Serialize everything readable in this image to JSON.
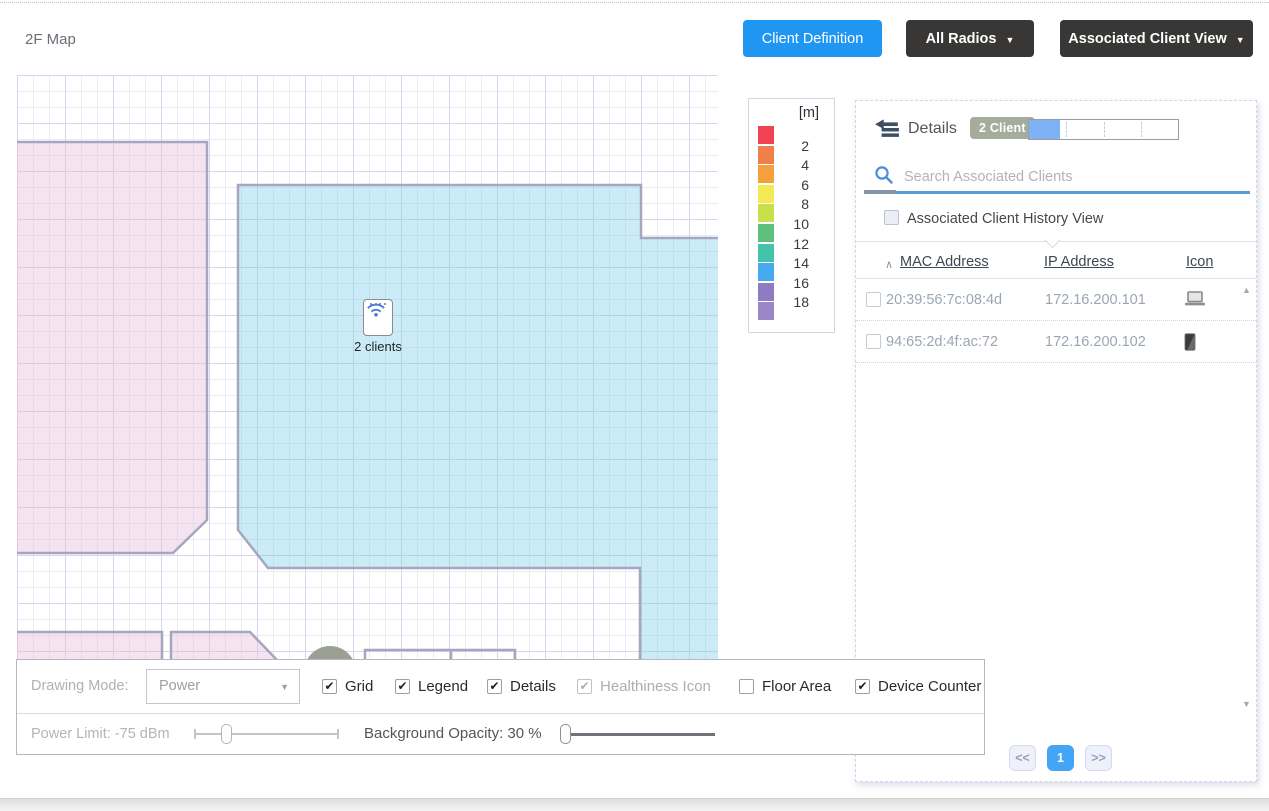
{
  "header": {
    "title": "2F Map",
    "client_definition_label": "Client Definition",
    "all_radios_label": "All Radios",
    "associated_client_view_label": "Associated Client View"
  },
  "glyphs": {
    "check": "✔",
    "caret_down": "▼",
    "select_caret": "▼",
    "sort_asc": "∧",
    "scroll_up": "▲",
    "scroll_down": "▼"
  },
  "map": {
    "ap_label": "2 clients"
  },
  "legend": {
    "unit": "[m]",
    "values": [
      2,
      4,
      6,
      8,
      10,
      12,
      14,
      16,
      18
    ],
    "colors": [
      "#f04155",
      "#f08049",
      "#f5a03c",
      "#f2ea50",
      "#c8e04c",
      "#5fc07e",
      "#43c3ae",
      "#45aaf0",
      "#8e7bc4",
      "#9b86c8"
    ]
  },
  "panel": {
    "back_label": "Details",
    "badge": "2 Client",
    "progress_percent": 21,
    "search_placeholder": "Search Associated Clients",
    "history_checkbox_label": "Associated Client History View",
    "history_checked": false,
    "table": {
      "columns": [
        "MAC Address",
        "IP Address",
        "Icon"
      ],
      "rows": [
        {
          "mac": "20:39:56:7c:08:4d",
          "ip": "172.16.200.101",
          "icon": "laptop",
          "checked": false
        },
        {
          "mac": "94:65:2d:4f:ac:72",
          "ip": "172.16.200.102",
          "icon": "smartphone",
          "checked": false
        }
      ]
    },
    "pagination": {
      "prev": "<<",
      "page": "1",
      "next": ">>"
    }
  },
  "toolbar": {
    "drawing_mode_label": "Drawing Mode:",
    "drawing_mode_value": "Power",
    "checkboxes": [
      {
        "label": "Grid",
        "checked": true,
        "disabled": false
      },
      {
        "label": "Legend",
        "checked": true,
        "disabled": false
      },
      {
        "label": "Details",
        "checked": true,
        "disabled": false
      },
      {
        "label": "Healthiness Icon",
        "checked": true,
        "disabled": true
      },
      {
        "label": "Floor Area",
        "checked": false,
        "disabled": false
      },
      {
        "label": "Device Counter",
        "checked": true,
        "disabled": false
      }
    ],
    "power_limit_label": "Power Limit: -75 dBm",
    "background_opacity_label": "Background Opacity: 30 %"
  },
  "colors": {
    "accent_blue": "#2096f3",
    "dark_button": "#383735",
    "progress_fill": "#7eb1f6",
    "pagination_active": "#42a5f5",
    "search_underline": "#5b9bd5",
    "badge_bg": "#a6ac9b",
    "wall": "#a6a6bd",
    "map_pink": "rgba(230,186,218,0.40)",
    "map_blue": "rgba(125,208,232,0.40)",
    "dome_gray": "#9aa094",
    "wifi_blue": "#4a7fd8"
  }
}
